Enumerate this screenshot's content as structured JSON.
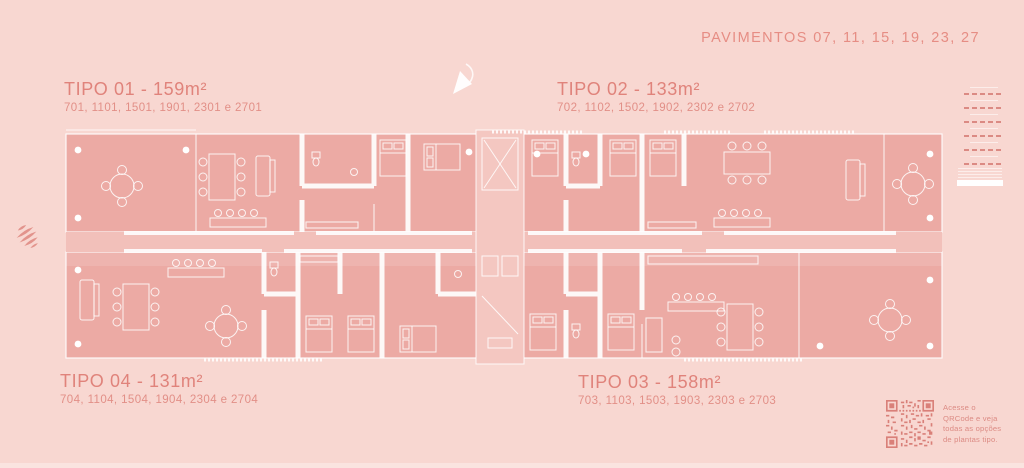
{
  "header": {
    "pavimentos_label": "PAVIMENTOS 07, 11, 15, 19, 23, 27"
  },
  "plan_types": [
    {
      "id": "tipo-01",
      "title": "TIPO 01 - 159m²",
      "units": "701, 1101, 1501, 1901, 2301 e 2701"
    },
    {
      "id": "tipo-02",
      "title": "TIPO 02 - 133m²",
      "units": "702, 1102, 1502, 1902, 2302 e 2702"
    },
    {
      "id": "tipo-03",
      "title": "TIPO 03 - 158m²",
      "units": "703, 1103, 1503, 1903, 2303 e 2703"
    },
    {
      "id": "tipo-04",
      "title": "TIPO 04 - 131m²",
      "units": "704, 1104, 1504, 1904, 2304 e 2704"
    }
  ],
  "qr": {
    "caption_lines": [
      "Acesse o",
      "QRCode e veja",
      "todas as opções",
      "de plantas tipo."
    ]
  },
  "icons": {
    "north_arrow": "north-arrow-icon",
    "brand_mark": "brand-mark-icon",
    "qr_code": "qr-code",
    "building_elevation": "building-elevation-diagram"
  },
  "colors": {
    "background": "#f8d7d1",
    "plan_fill": "#ecaaa4",
    "core_fill": "#f4c7c1",
    "corridor_fill": "#f2c0ba",
    "accent_text": "#e0837b",
    "accent_text_small": "#e28f87",
    "salmon_graphic": "#db8a83",
    "line_white": "#ffffff"
  }
}
